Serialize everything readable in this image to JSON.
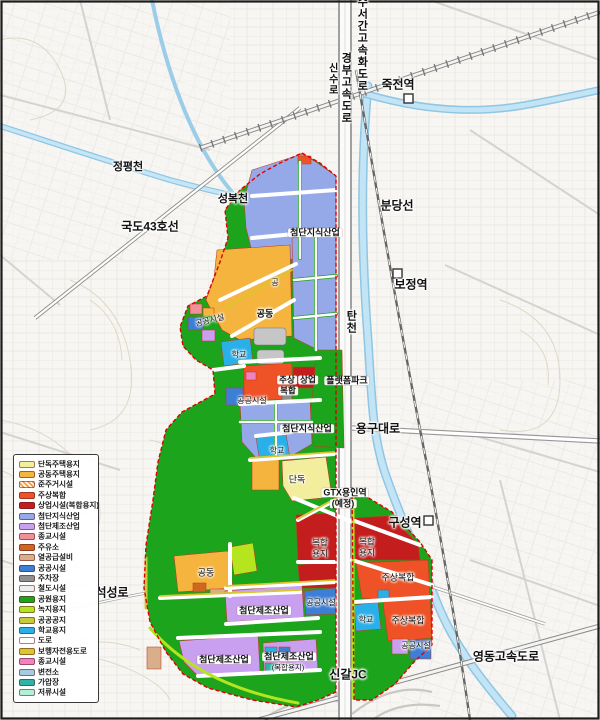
{
  "legend": {
    "items": [
      {
        "key": "danok",
        "label": "단독주택용지",
        "color": "#f2ee9e"
      },
      {
        "key": "gongdong",
        "label": "공동주택용지",
        "color": "#f4b43e"
      },
      {
        "key": "junjuger",
        "label": "준주거시설",
        "color": "#f2a04e",
        "hatch": true
      },
      {
        "key": "jusang",
        "label": "주상복합",
        "color": "#ee5226"
      },
      {
        "key": "sangup",
        "label": "상업시설(복합용지)",
        "color": "#c41d1d"
      },
      {
        "key": "jisik",
        "label": "첨단지식산업",
        "color": "#95a9e8"
      },
      {
        "key": "jejo",
        "label": "첨단제조산업",
        "color": "#c99fef"
      },
      {
        "key": "jonggyo1",
        "label": "종교시설",
        "color": "#f2909a"
      },
      {
        "key": "juyuso",
        "label": "주유소",
        "color": "#cf671f"
      },
      {
        "key": "yeol",
        "label": "열공급설비",
        "color": "#d9af8b"
      },
      {
        "key": "gonggong",
        "label": "공공시설",
        "color": "#3b7fd6"
      },
      {
        "key": "jucha",
        "label": "주차장",
        "color": "#8f9090"
      },
      {
        "key": "cheoldo",
        "label": "철도시설",
        "color": "#ededeb"
      },
      {
        "key": "park",
        "label": "공원용지",
        "color": "#1ca41c"
      },
      {
        "key": "nokji",
        "label": "녹지용지",
        "color": "#b4e51e"
      },
      {
        "key": "gonggongji",
        "label": "공공공지",
        "color": "#c9c93f"
      },
      {
        "key": "hakgyo",
        "label": "학교용지",
        "color": "#2ab0e8"
      },
      {
        "key": "doro",
        "label": "도로",
        "color": "#ffffff"
      },
      {
        "key": "bohaeng",
        "label": "보행자전용도로",
        "color": "#d9c72b"
      },
      {
        "key": "jonggyo2",
        "label": "종교시설",
        "color": "#ef82c3"
      },
      {
        "key": "byeonjeon",
        "label": "변전소",
        "color": "#a5cae2"
      },
      {
        "key": "gaap",
        "label": "가압장",
        "color": "#2fb2a8"
      },
      {
        "key": "jeoryu",
        "label": "저류시설",
        "color": "#aff0d6"
      }
    ]
  },
  "map": {
    "labels": [
      {
        "text": "수서간고속화도로",
        "x": 361,
        "y": 44,
        "size": 11,
        "bold": true,
        "vertical": true
      },
      {
        "text": "신수로",
        "x": 331,
        "y": 79,
        "size": 10,
        "bold": true,
        "vertical": true
      },
      {
        "text": "경부고속도로",
        "x": 345,
        "y": 88,
        "size": 11,
        "bold": true,
        "vertical": true
      },
      {
        "text": "죽전역",
        "x": 398,
        "y": 85,
        "size": 12,
        "bold": true
      },
      {
        "text": "정평천",
        "x": 128,
        "y": 168,
        "size": 11,
        "bold": true
      },
      {
        "text": "성복천",
        "x": 233,
        "y": 200,
        "size": 11,
        "bold": true
      },
      {
        "text": "국도43호선",
        "x": 150,
        "y": 227,
        "size": 12,
        "bold": true
      },
      {
        "text": "분당선",
        "x": 397,
        "y": 206,
        "size": 12,
        "bold": true
      },
      {
        "text": "보정역",
        "x": 411,
        "y": 285,
        "size": 12,
        "bold": true
      },
      {
        "text": "탄천",
        "x": 350,
        "y": 322,
        "size": 11,
        "bold": true,
        "vertical": true
      },
      {
        "text": "첨단지식산업",
        "x": 315,
        "y": 233,
        "size": 9,
        "bold": true,
        "boxed": true
      },
      {
        "text": "공",
        "x": 275,
        "y": 283,
        "size": 8
      },
      {
        "text": "공동",
        "x": 265,
        "y": 314,
        "size": 9,
        "bold": true
      },
      {
        "text": "공공시설",
        "x": 210,
        "y": 321,
        "size": 8,
        "rotate": -14
      },
      {
        "text": "학교",
        "x": 239,
        "y": 355,
        "size": 8
      },
      {
        "text": "주상",
        "x": 287,
        "y": 380,
        "size": 8.5,
        "bold": true,
        "boxed": true
      },
      {
        "text": "복합",
        "x": 288,
        "y": 391,
        "size": 8.5,
        "bold": true,
        "boxed": true
      },
      {
        "text": "상업",
        "x": 308,
        "y": 380,
        "size": 8.5,
        "bold": true,
        "boxed": true
      },
      {
        "text": "플랫폼파크",
        "x": 347,
        "y": 381,
        "size": 9,
        "bold": true,
        "boxed": true
      },
      {
        "text": "공공시설",
        "x": 252,
        "y": 401,
        "size": 8
      },
      {
        "text": "첨단지식산업",
        "x": 307,
        "y": 429,
        "size": 9,
        "bold": true,
        "boxed": true
      },
      {
        "text": "용구대로",
        "x": 378,
        "y": 429,
        "size": 12,
        "bold": true
      },
      {
        "text": "학교",
        "x": 277,
        "y": 451,
        "size": 8
      },
      {
        "text": "단독",
        "x": 297,
        "y": 480,
        "size": 9
      },
      {
        "text": "GTX용인역",
        "x": 345,
        "y": 493,
        "size": 9,
        "bold": true,
        "boxed": true
      },
      {
        "text": "(예정)",
        "x": 343,
        "y": 504,
        "size": 9,
        "bold": true,
        "boxed": true
      },
      {
        "text": "구성역",
        "x": 405,
        "y": 523,
        "size": 12,
        "bold": true
      },
      {
        "text": "복합",
        "x": 320,
        "y": 543,
        "size": 8.5
      },
      {
        "text": "용지",
        "x": 320,
        "y": 554,
        "size": 8.5
      },
      {
        "text": "복합",
        "x": 367,
        "y": 542,
        "size": 8.5
      },
      {
        "text": "용지",
        "x": 367,
        "y": 553,
        "size": 8.5
      },
      {
        "text": "공동",
        "x": 206,
        "y": 573,
        "size": 9
      },
      {
        "text": "주상복합",
        "x": 398,
        "y": 578,
        "size": 9
      },
      {
        "text": "석성로",
        "x": 112,
        "y": 593,
        "size": 12,
        "bold": true
      },
      {
        "text": "공공시설",
        "x": 321,
        "y": 603,
        "size": 8
      },
      {
        "text": "첨단제조산업",
        "x": 264,
        "y": 611,
        "size": 9,
        "bold": true,
        "boxed": true
      },
      {
        "text": "학교",
        "x": 366,
        "y": 620,
        "size": 8
      },
      {
        "text": "주상복합",
        "x": 408,
        "y": 621,
        "size": 9
      },
      {
        "text": "공공시설",
        "x": 416,
        "y": 646,
        "size": 8
      },
      {
        "text": "첨단제조산업",
        "x": 224,
        "y": 660,
        "size": 9,
        "bold": true,
        "boxed": true
      },
      {
        "text": "첨단제조산업",
        "x": 289,
        "y": 657,
        "size": 9,
        "bold": true,
        "boxed": true
      },
      {
        "text": "(복합용지)",
        "x": 288,
        "y": 668,
        "size": 7.5
      },
      {
        "text": "영동고속도로",
        "x": 506,
        "y": 657,
        "size": 12,
        "bold": true
      },
      {
        "text": "신갈JC",
        "x": 348,
        "y": 675,
        "size": 12,
        "bold": true
      }
    ]
  }
}
